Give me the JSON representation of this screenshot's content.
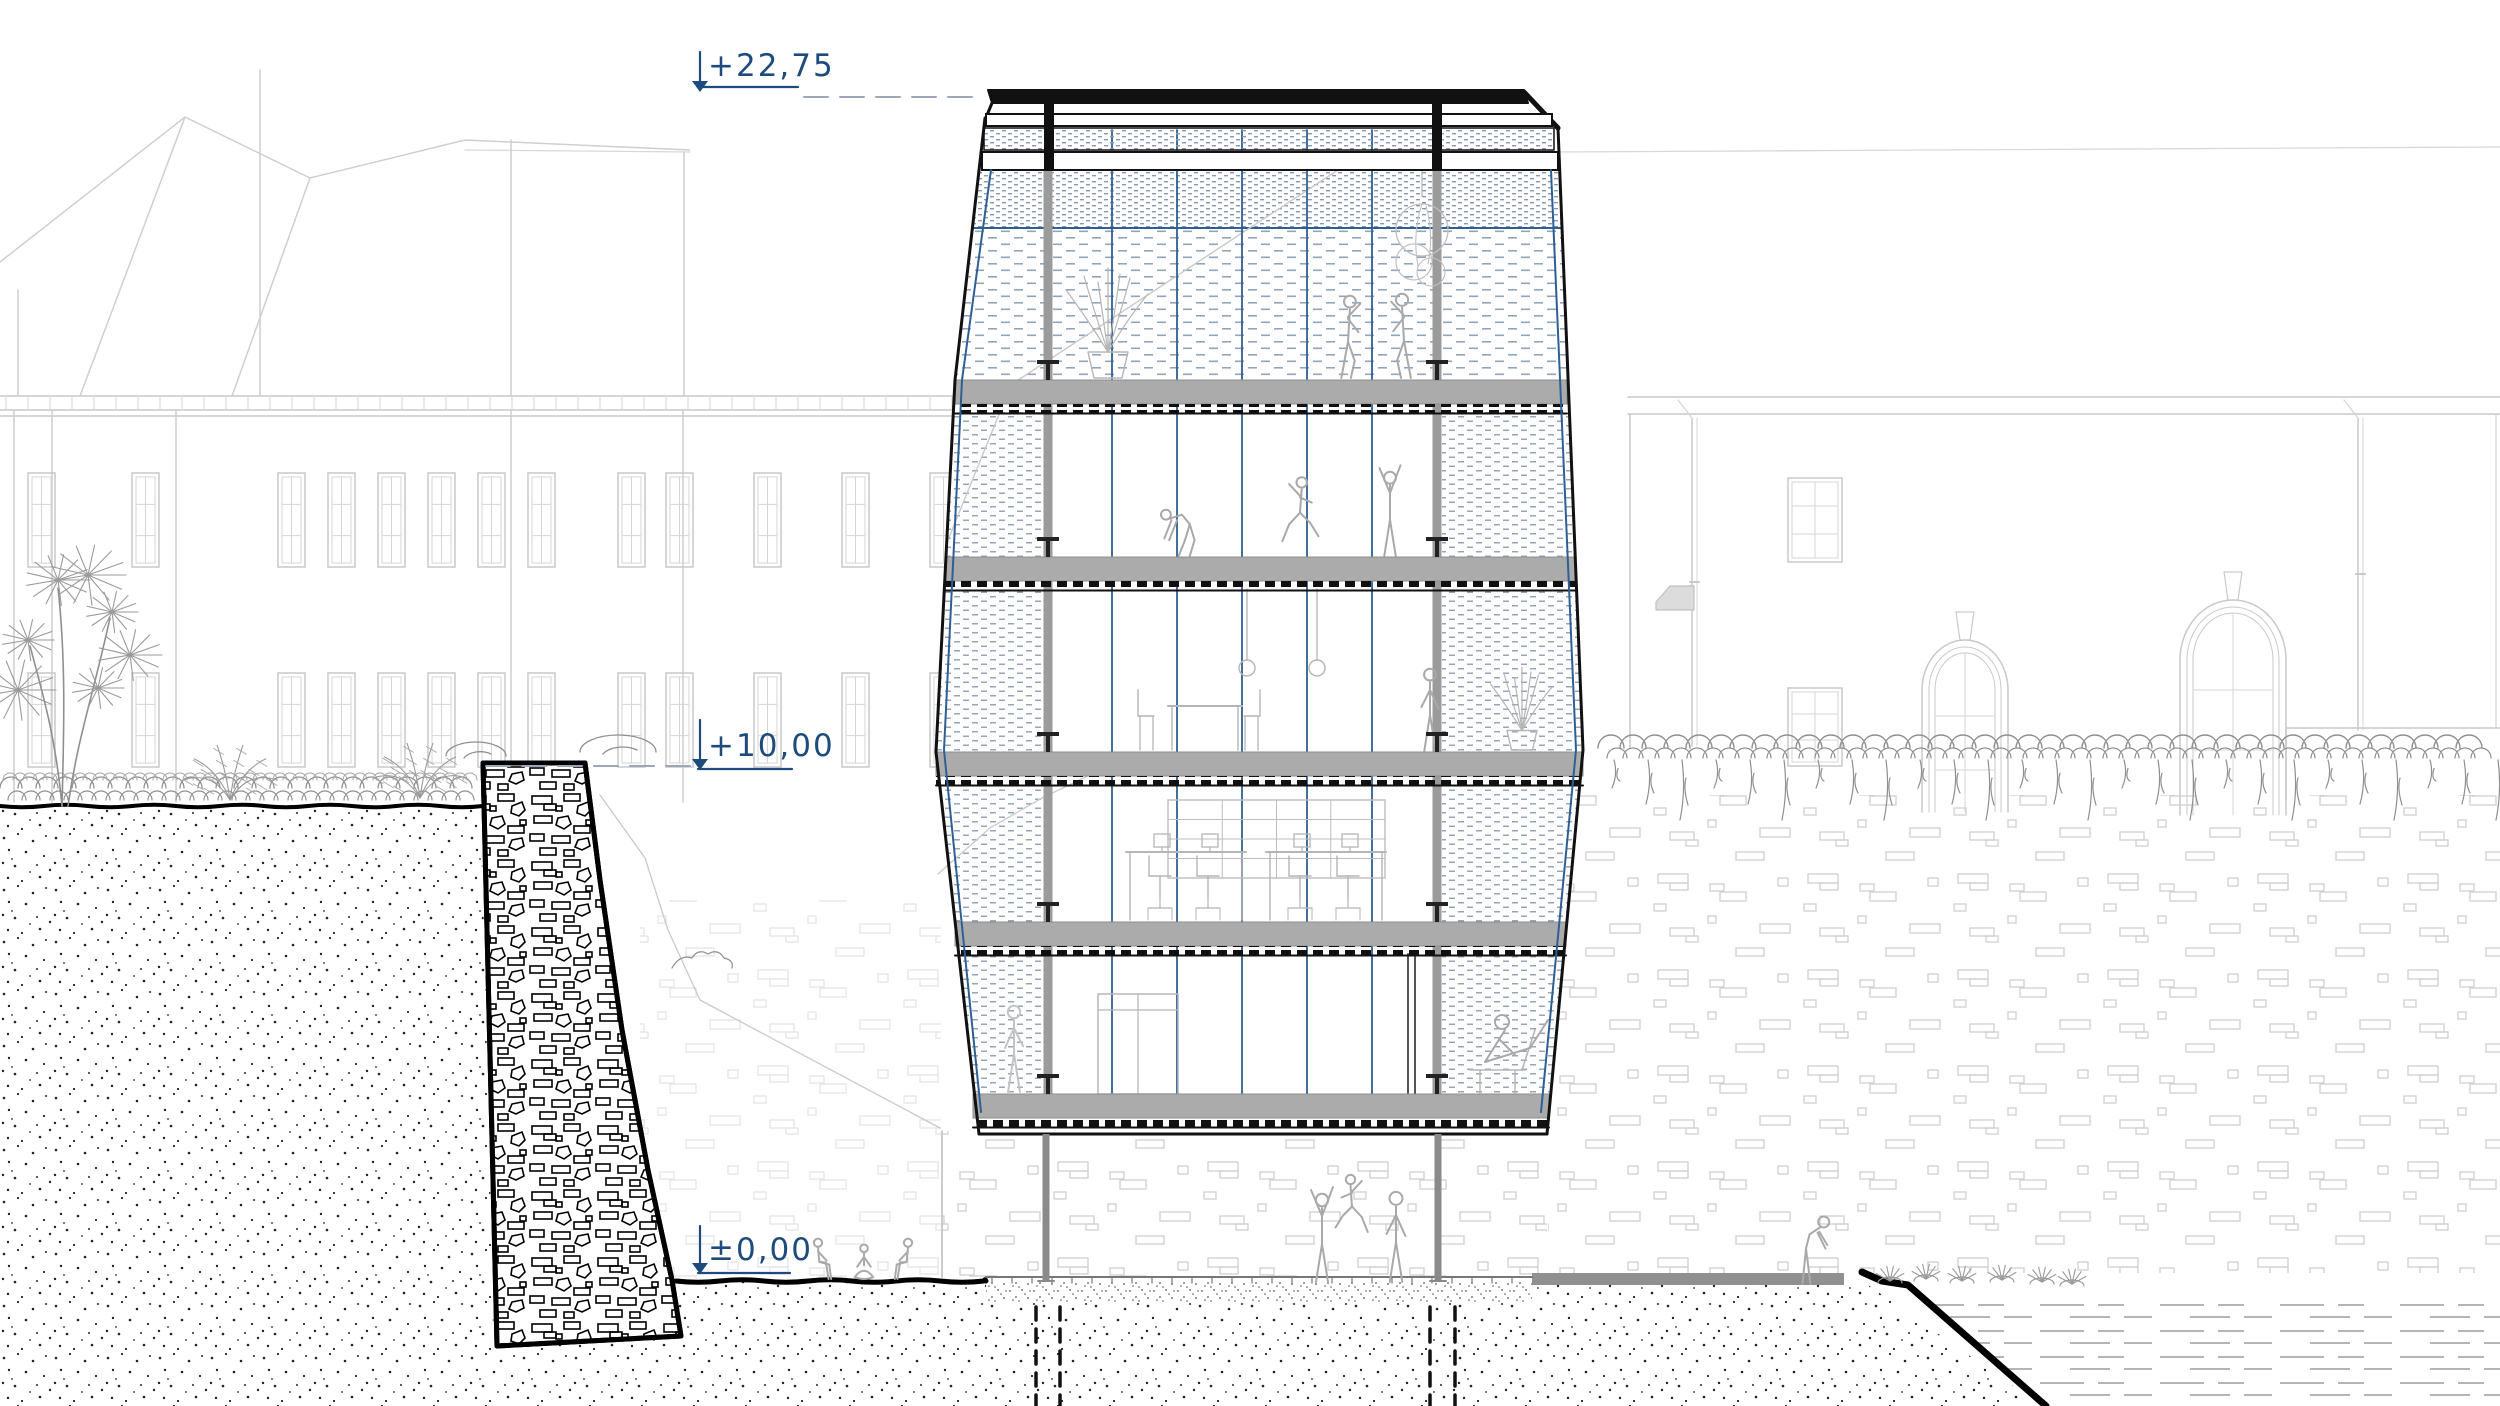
{
  "canvas": {
    "w": 2500,
    "h": 1406,
    "bg": "#ffffff"
  },
  "palette": {
    "ink": "#111111",
    "navy": "#1e4b7d",
    "cable_blue": "#2e5f94",
    "dash_line": "#9aa7b8",
    "faint": "#c9c9c9",
    "brick": "#cfcfcf",
    "figure": "#a9a9a9",
    "figure_light": "#c4c4c4",
    "slab_gray": "#ababab",
    "mid_gray": "#8f8f8f",
    "veg": "#8f8f8f",
    "furn": "#b5b5b5"
  },
  "annotations": {
    "levels": {
      "top": {
        "label": "+22,75",
        "tick_x": 700,
        "tick_y1": 52,
        "tick_y2": 90,
        "text_left": 708,
        "text_top": 48,
        "underline": [
          698,
          798,
          87
        ],
        "dash": [
          804,
          984,
          97
        ]
      },
      "mid": {
        "label": "+10,00",
        "tick_x": 700,
        "tick_y1": 720,
        "tick_y2": 768,
        "text_left": 708,
        "text_top": 728,
        "underline": [
          698,
          792,
          769
        ],
        "dash": [
          486,
          694,
          766
        ]
      },
      "zero": {
        "label": "±0,00",
        "tick_x": 700,
        "tick_y1": 1226,
        "tick_y2": 1272,
        "text_left": 708,
        "text_top": 1232,
        "underline": [
          698,
          790,
          1273
        ],
        "dash": null
      }
    }
  },
  "background": {
    "hill_polylines": [
      "0,262 185,117 310,178 465,140 690,150",
      "185,117 80,396",
      "310,178 232,396"
    ],
    "ridge_right": [
      1558,
      152,
      2500,
      147
    ],
    "left_building": {
      "cornice_y": [
        396,
        410,
        416
      ],
      "cornice_x": [
        0,
        986
      ],
      "tick_step": 22,
      "pilasters": [
        [
          14,
          410,
          802
        ],
        [
          52,
          410,
          802
        ],
        [
          176,
          410,
          802
        ],
        [
          511,
          410,
          802
        ],
        [
          683,
          410,
          802
        ],
        [
          260,
          70,
          396
        ],
        [
          511,
          140,
          396
        ],
        [
          684,
          152,
          396
        ],
        [
          18,
          290,
          396
        ]
      ],
      "window_w": 27,
      "window_x": [
        28,
        132,
        278,
        328,
        378,
        428,
        478,
        528,
        618,
        666,
        754,
        842,
        930
      ],
      "window_rows": [
        [
          473,
          94
        ],
        [
          673,
          94
        ]
      ]
    },
    "right_building": {
      "eaves": [
        [
          1628,
          397,
          2500,
          397
        ],
        [
          1628,
          414,
          2500,
          414
        ]
      ],
      "corner": [
        1630,
        414,
        748
      ],
      "corner2": [
        2496,
        414,
        728
      ],
      "downpipes": [
        [
          1692,
          418,
          746
        ],
        [
          2358,
          418,
          730
        ]
      ],
      "small_windows": [
        [
          1788,
          478,
          54,
          84
        ],
        [
          1788,
          688,
          54,
          78
        ]
      ],
      "shed": [
        1656,
        586,
        1694,
        610
      ],
      "arch_windows": [
        {
          "x1": 1922,
          "x2": 2008,
          "apex": 640,
          "spring": 690,
          "bottom": 812,
          "mull_h": [
            716,
            770
          ]
        },
        {
          "x1": 2180,
          "x2": 2286,
          "apex": 600,
          "spring": 660,
          "bottom": 815,
          "mull_h": [
            690,
            750
          ]
        }
      ],
      "parapet": [
        2286,
        728,
        2500,
        800
      ]
    }
  },
  "terrain": {
    "left_ground": [
      0,
      806,
      483
    ],
    "lower_ground": [
      676,
      1281,
      986
    ],
    "soil_a": "M0,808 L481,808 L494,1346 L681,1337 L686,1406 L0,1406 Z",
    "soil_b": "M676,1281 L986,1281 L986,1303 L1532,1303 L1532,1285 L1868,1285 L2042,1406 L686,1406 Z",
    "gravel": [
      986,
      1281,
      1532,
      1303
    ],
    "paver": [
      986,
      1277,
      1532
    ],
    "gray_strip": [
      1532,
      1273,
      1844,
      1285
    ],
    "cliff": "M1862,1272 l20,9 l26,4 L2046,1406",
    "water": "M1916,1292 L2500,1292 L2500,1406 L2052,1406 Z",
    "piles": [
      1036,
      1060,
      1430,
      1455
    ],
    "pile_y": 1307,
    "brick_regions": [
      [
        942,
        1131,
        1547,
        1277,
        1
      ],
      [
        1548,
        795,
        2500,
        1273,
        1
      ],
      [
        640,
        900,
        941,
        1279,
        0.55
      ]
    ],
    "corner_line": [
      942,
      1131,
      1277
    ],
    "slope_line": "M600,795 L645,858 L668,930 L700,1000 L940,1128"
  },
  "wall": {
    "outline": "M483,763 L585,763 L600,880 L622,1030 L648,1170 L672,1280 L681,1336 L497,1346 Z",
    "bushes": [
      [
        476,
        756,
        30,
        14
      ],
      [
        618,
        752,
        38,
        17
      ]
    ],
    "slope_bush": [
      700,
      968
    ]
  },
  "plants": {
    "dracaena": {
      "x": 62,
      "y": 806,
      "tips": [
        [
          28,
          640
        ],
        [
          58,
          580
        ],
        [
          88,
          575
        ],
        [
          112,
          612
        ],
        [
          130,
          655
        ],
        [
          18,
          690
        ],
        [
          98,
          688
        ]
      ]
    },
    "ferns": [
      [
        230,
        800
      ],
      [
        420,
        798
      ]
    ],
    "hedge_left": [
      0,
      483,
      788
    ],
    "vine_right": [
      1598,
      2500,
      748
    ],
    "tufts": [
      [
        1890,
        1283
      ],
      [
        1926,
        1281
      ],
      [
        1962,
        1283
      ],
      [
        2002,
        1282
      ],
      [
        2042,
        1284
      ],
      [
        2072,
        1286
      ]
    ]
  },
  "tower": {
    "fill_outline": "M988,90 L1524,90 L1558,128 L1583,750 L1547,1134 L979,1134 L936,752 L955,380 L985,118 Z",
    "roof": {
      "top_band": "M988,90 L1524,90 L1528,103 L992,103 Z",
      "chamfer_left": [
        992,
        103,
        985,
        120
      ],
      "chamfer_right": [
        1524,
        92,
        1558,
        128
      ],
      "rail": [
        986,
        114,
        1552,
        126
      ],
      "posts": [
        1044,
        1432
      ],
      "mesh_band": [
        984,
        128,
        1554,
        150
      ],
      "beam": [
        982,
        152,
        1558,
        170
      ]
    },
    "edges": {
      "left": "M985,118 L955,380 L936,752 L979,1134",
      "right": "M1558,128 L1583,750 L1547,1134",
      "bottom": [
        979,
        1134,
        1547
      ],
      "inner_left": "M991,170 L962,380 L944,750 L981,1112",
      "inner_right": "M1551,170 L1576,750 L1541,1112"
    },
    "mesh": {
      "top_fine": "M979,170 L1559,170 L1561,228 L972,228 Z",
      "top_wide": "M972,228 L1561,228 L1567,380 L955,380 Z",
      "divider": [
        972,
        228,
        1561
      ],
      "bands": [
        "M954,412 L1044,412 L1044,557 L946,557 Z",
        "M945,589 L1044,589 L1044,752 L936,752 Z",
        "M938,784 L1044,784 L1044,922 L955,922 Z",
        "M957,954 L1044,954 L1044,1094 L973,1094 Z",
        "M1442,412 L1568,412 L1575,557 L1442,557 Z",
        "M1442,589 L1576,589 L1583,752 L1442,752 Z",
        "M1442,784 L1581,784 L1566,922 L1442,922 Z",
        "M1442,954 L1563,954 L1549,1094 L1442,1094 Z"
      ]
    },
    "slabs": [
      [
        380,
        955,
        1567
      ],
      [
        557,
        946,
        1575
      ],
      [
        752,
        936,
        1583
      ],
      [
        922,
        955,
        1566
      ],
      [
        1094,
        973,
        1549
      ]
    ],
    "columns_x": [
      1048,
      1437
    ],
    "cables_x": [
      1112,
      1177,
      1242,
      1307,
      1372
    ],
    "under_columns": {
      "x": [
        1046,
        1438
      ],
      "y1": 1134,
      "y2": 1281
    },
    "faint_diag": [
      [
        1338,
        170,
        1000,
        392
      ],
      [
        1000,
        412,
        948,
        540
      ]
    ],
    "terrain_faint": "M938,874 L990,828 L1042,798 L1096,772",
    "door": [
      1098,
      994,
      1178,
      1094
    ],
    "dark_lines": {
      "x": [
        1408,
        1415
      ],
      "y1": 954,
      "y2": 1094
    }
  },
  "furniture": [
    {
      "type": "pot_plant",
      "x": 1108,
      "y": 378,
      "s": 1
    },
    {
      "type": "hanging_plant",
      "x": 1422,
      "y": 170
    },
    {
      "type": "rings",
      "x1": 1247,
      "x2": 1317,
      "y1": 589,
      "y2": 660
    },
    {
      "type": "table_chairs",
      "x": 1205,
      "y": 750
    },
    {
      "type": "shelf",
      "x": 1168,
      "y": 800,
      "w": 217,
      "h": 78
    },
    {
      "type": "desk",
      "x": 1126,
      "y": 920
    },
    {
      "type": "desk",
      "x": 1266,
      "y": 920
    },
    {
      "type": "pot_plant",
      "x": 1522,
      "y": 750,
      "s": 0.75
    },
    {
      "type": "recline",
      "x": 1500,
      "y": 1093
    }
  ],
  "figures": [
    {
      "pose": "dance",
      "x": 1348,
      "y": 378,
      "h": 84,
      "flip": false
    },
    {
      "pose": "dance",
      "x": 1404,
      "y": 378,
      "h": 86,
      "flip": true
    },
    {
      "pose": "bend",
      "x": 1185,
      "y": 556,
      "h": 70,
      "flip": false
    },
    {
      "pose": "jump",
      "x": 1300,
      "y": 548,
      "h": 74,
      "flip": false
    },
    {
      "pose": "reach",
      "x": 1390,
      "y": 556,
      "h": 84,
      "flip": false
    },
    {
      "pose": "stand",
      "x": 1430,
      "y": 751,
      "h": 84,
      "flip": true
    },
    {
      "pose": "stand",
      "x": 1014,
      "y": 1092,
      "h": 88,
      "flip": false,
      "tone": "light"
    },
    {
      "pose": "reach",
      "x": 1322,
      "y": 1282,
      "h": 88,
      "flip": false
    },
    {
      "pose": "jump",
      "x": 1352,
      "y": 1238,
      "h": 66,
      "flip": true
    },
    {
      "pose": "stand",
      "x": 1396,
      "y": 1282,
      "h": 92,
      "flip": true
    },
    {
      "pose": "sit",
      "x": 818,
      "y": 1279,
      "h": 58,
      "flip": false
    },
    {
      "pose": "sitcross",
      "x": 864,
      "y": 1279,
      "h": 54,
      "flip": false
    },
    {
      "pose": "sit",
      "x": 908,
      "y": 1279,
      "h": 58,
      "flip": true
    },
    {
      "pose": "lean",
      "x": 1806,
      "y": 1284,
      "h": 78,
      "flip": false
    }
  ]
}
